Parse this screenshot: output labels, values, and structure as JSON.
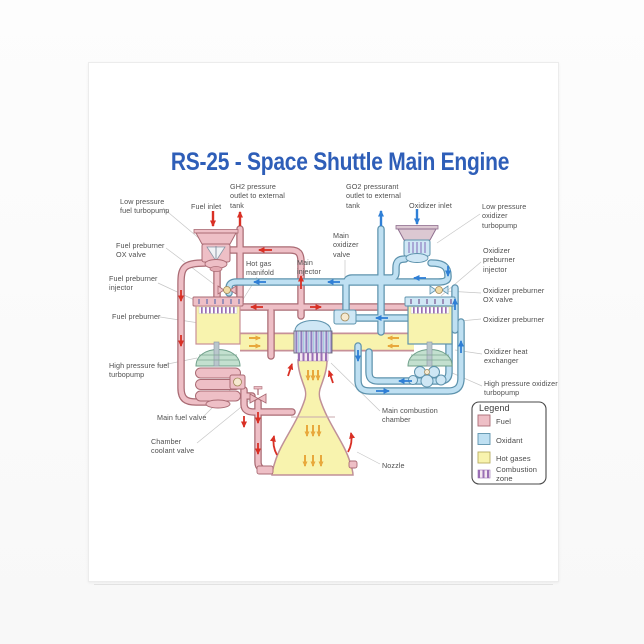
{
  "page": {
    "title": "RS-25 - Space Shuttle Main Engine"
  },
  "colors": {
    "title_blue": "#2e5eb8",
    "fuel": "#eebfc6",
    "fuel_outline": "#aa6b74",
    "oxidant": "#bfe0f2",
    "oxidant_outline": "#5e93ad",
    "hot_gases": "#f8f3ae",
    "combustion_purple": "#9a6fb5",
    "turbine_green": "#c3e0cf",
    "arrow_red": "#d93025",
    "arrow_blue": "#2f7fd6",
    "arrow_orange": "#e8a83c",
    "label_gray": "#4f4f4f"
  },
  "diagram": {
    "labels": {
      "lp_fuel_turbopump": "Low pressure fuel turbopump",
      "fuel_inlet": "Fuel inlet",
      "gh2_outlet": "GH2 pressure outlet to external tank",
      "go2_outlet": "GO2 pressurant outlet to external tank",
      "oxidizer_inlet": "Oxidizer inlet",
      "lp_ox_turbopump": "Low pressure oxidizer turbopump",
      "fuel_preburner_ox_valve": "Fuel preburner OX valve",
      "fuel_preburner_injector": "Fuel preburner injector",
      "fuel_preburner": "Fuel preburner",
      "hot_gas_manifold": "Hot gas manifold",
      "main_injector": "Main injector",
      "main_oxidizer_valve": "Main oxidizer valve",
      "ox_preburner_injector": "Oxidizer preburner injector",
      "ox_preburner_ox_valve": "Oxidizer preburner OX valve",
      "ox_preburner": "Oxidizer preburner",
      "ox_heat_exchanger": "Oxidizer heat exchanger",
      "hp_fuel_turbopump": "High pressure fuel turbopump",
      "hp_ox_turbopump": "High pressure oxidizer turbopump",
      "main_fuel_valve": "Main fuel valve",
      "chamber_coolant_valve": "Chamber coolant valve",
      "main_combustion_chamber": "Main combustion chamber",
      "nozzle": "Nozzle"
    }
  },
  "legend": {
    "title": "Legend",
    "items": [
      {
        "label": "Fuel",
        "color": "#eebfc6"
      },
      {
        "label": "Oxidant",
        "color": "#bfe0f2"
      },
      {
        "label": "Hot gases",
        "color": "#f8f3ae"
      },
      {
        "label": "Combustion zone",
        "color": "#9a6fb5"
      }
    ]
  }
}
